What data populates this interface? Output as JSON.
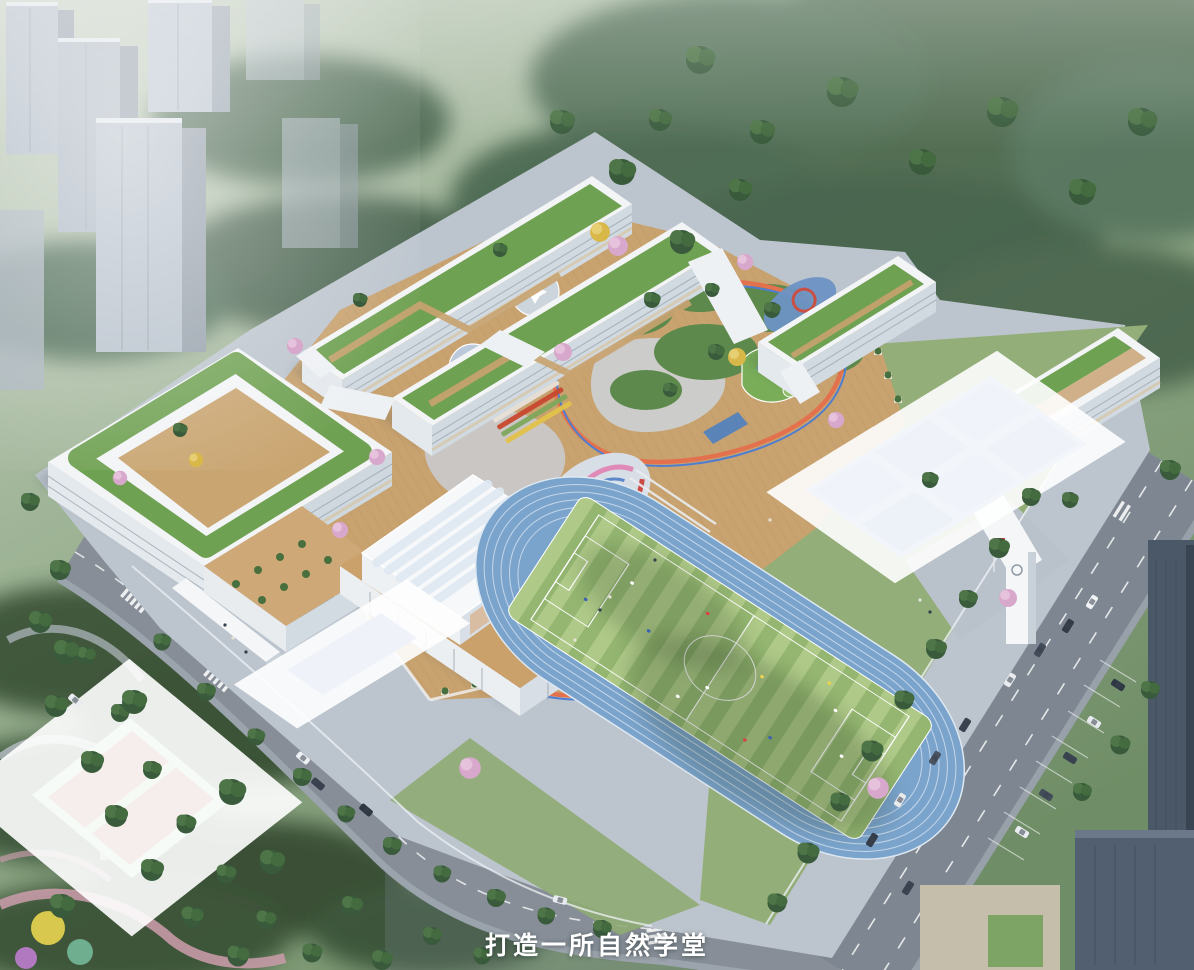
{
  "scene": {
    "type": "aerial architectural rendering",
    "subject": "green school campus masterplan bird's-eye view at dawn",
    "caption": {
      "text": "打造一所自然学堂"
    },
    "palette": {
      "haze": "#c6cfc3",
      "forest": "#3f5c42",
      "lawn": "#93ae78",
      "roof_green": "#6fa152",
      "deck_tan": "#c8a26f",
      "building_white": "#f2f4f6",
      "track_blue": "#7ba4cd",
      "field_light": "#aec988",
      "field_dark": "#94b671",
      "court_blue": "#5d87c6",
      "court_red": "#a65850",
      "court_fence_green": "#b3dfb0",
      "road_gray": "#878e98",
      "tower_gray": "#b3bdc8",
      "dark_tower": "#4b5868",
      "path_orange": "#e4714d",
      "path_blue": "#4f7ed0",
      "pond_blue": "#7fa9cf",
      "blossom_pink": "#d8a8cc",
      "flag_red": "#cc3b33"
    },
    "elements": [
      {
        "name": "residential-towers",
        "label": "gray high-rise towers in morning haze"
      },
      {
        "name": "forest-hillside",
        "label": "misty forested hillside backdrop"
      },
      {
        "name": "teaching-building-west",
        "label": "courtyard teaching building, green roof, terraced planters"
      },
      {
        "name": "teaching-building-north",
        "label": "double-bar teaching building with green roofs"
      },
      {
        "name": "building-northeast",
        "label": "slab building with green roof"
      },
      {
        "name": "building-east",
        "label": "east gate building with green roof"
      },
      {
        "name": "gymnasium",
        "label": "gymnasium with ribbed skylight roof and timber louvers"
      },
      {
        "name": "podium-courtyard",
        "label": "elevated timber deck with gardens and play loops"
      },
      {
        "name": "play-swirl",
        "label": "swirl-patterned children's playground"
      },
      {
        "name": "pond",
        "label": "landscape pond"
      },
      {
        "name": "running-track",
        "label": "blue running track"
      },
      {
        "name": "soccer-field",
        "label": "striped green soccer field"
      },
      {
        "name": "basketball-courts",
        "label": "six blue basketball courts"
      },
      {
        "name": "campus-court",
        "label": "single blue basketball court"
      },
      {
        "name": "public-courts",
        "label": "two red courts with green fence"
      },
      {
        "name": "clock-tower",
        "label": "white gate tower with red flag"
      },
      {
        "name": "entrance-canopy-west",
        "label": "west entrance canopy walkway"
      },
      {
        "name": "road-west",
        "label": "tree-lined street with crosswalks"
      },
      {
        "name": "road-east",
        "label": "wide avenue with traffic and lane markings"
      },
      {
        "name": "parking-lot",
        "label": "angled roadside parking"
      },
      {
        "name": "dark-highrises",
        "label": "dark high-rise blocks, lower right"
      },
      {
        "name": "city-park",
        "label": "park with winding paths and play circles"
      }
    ]
  }
}
